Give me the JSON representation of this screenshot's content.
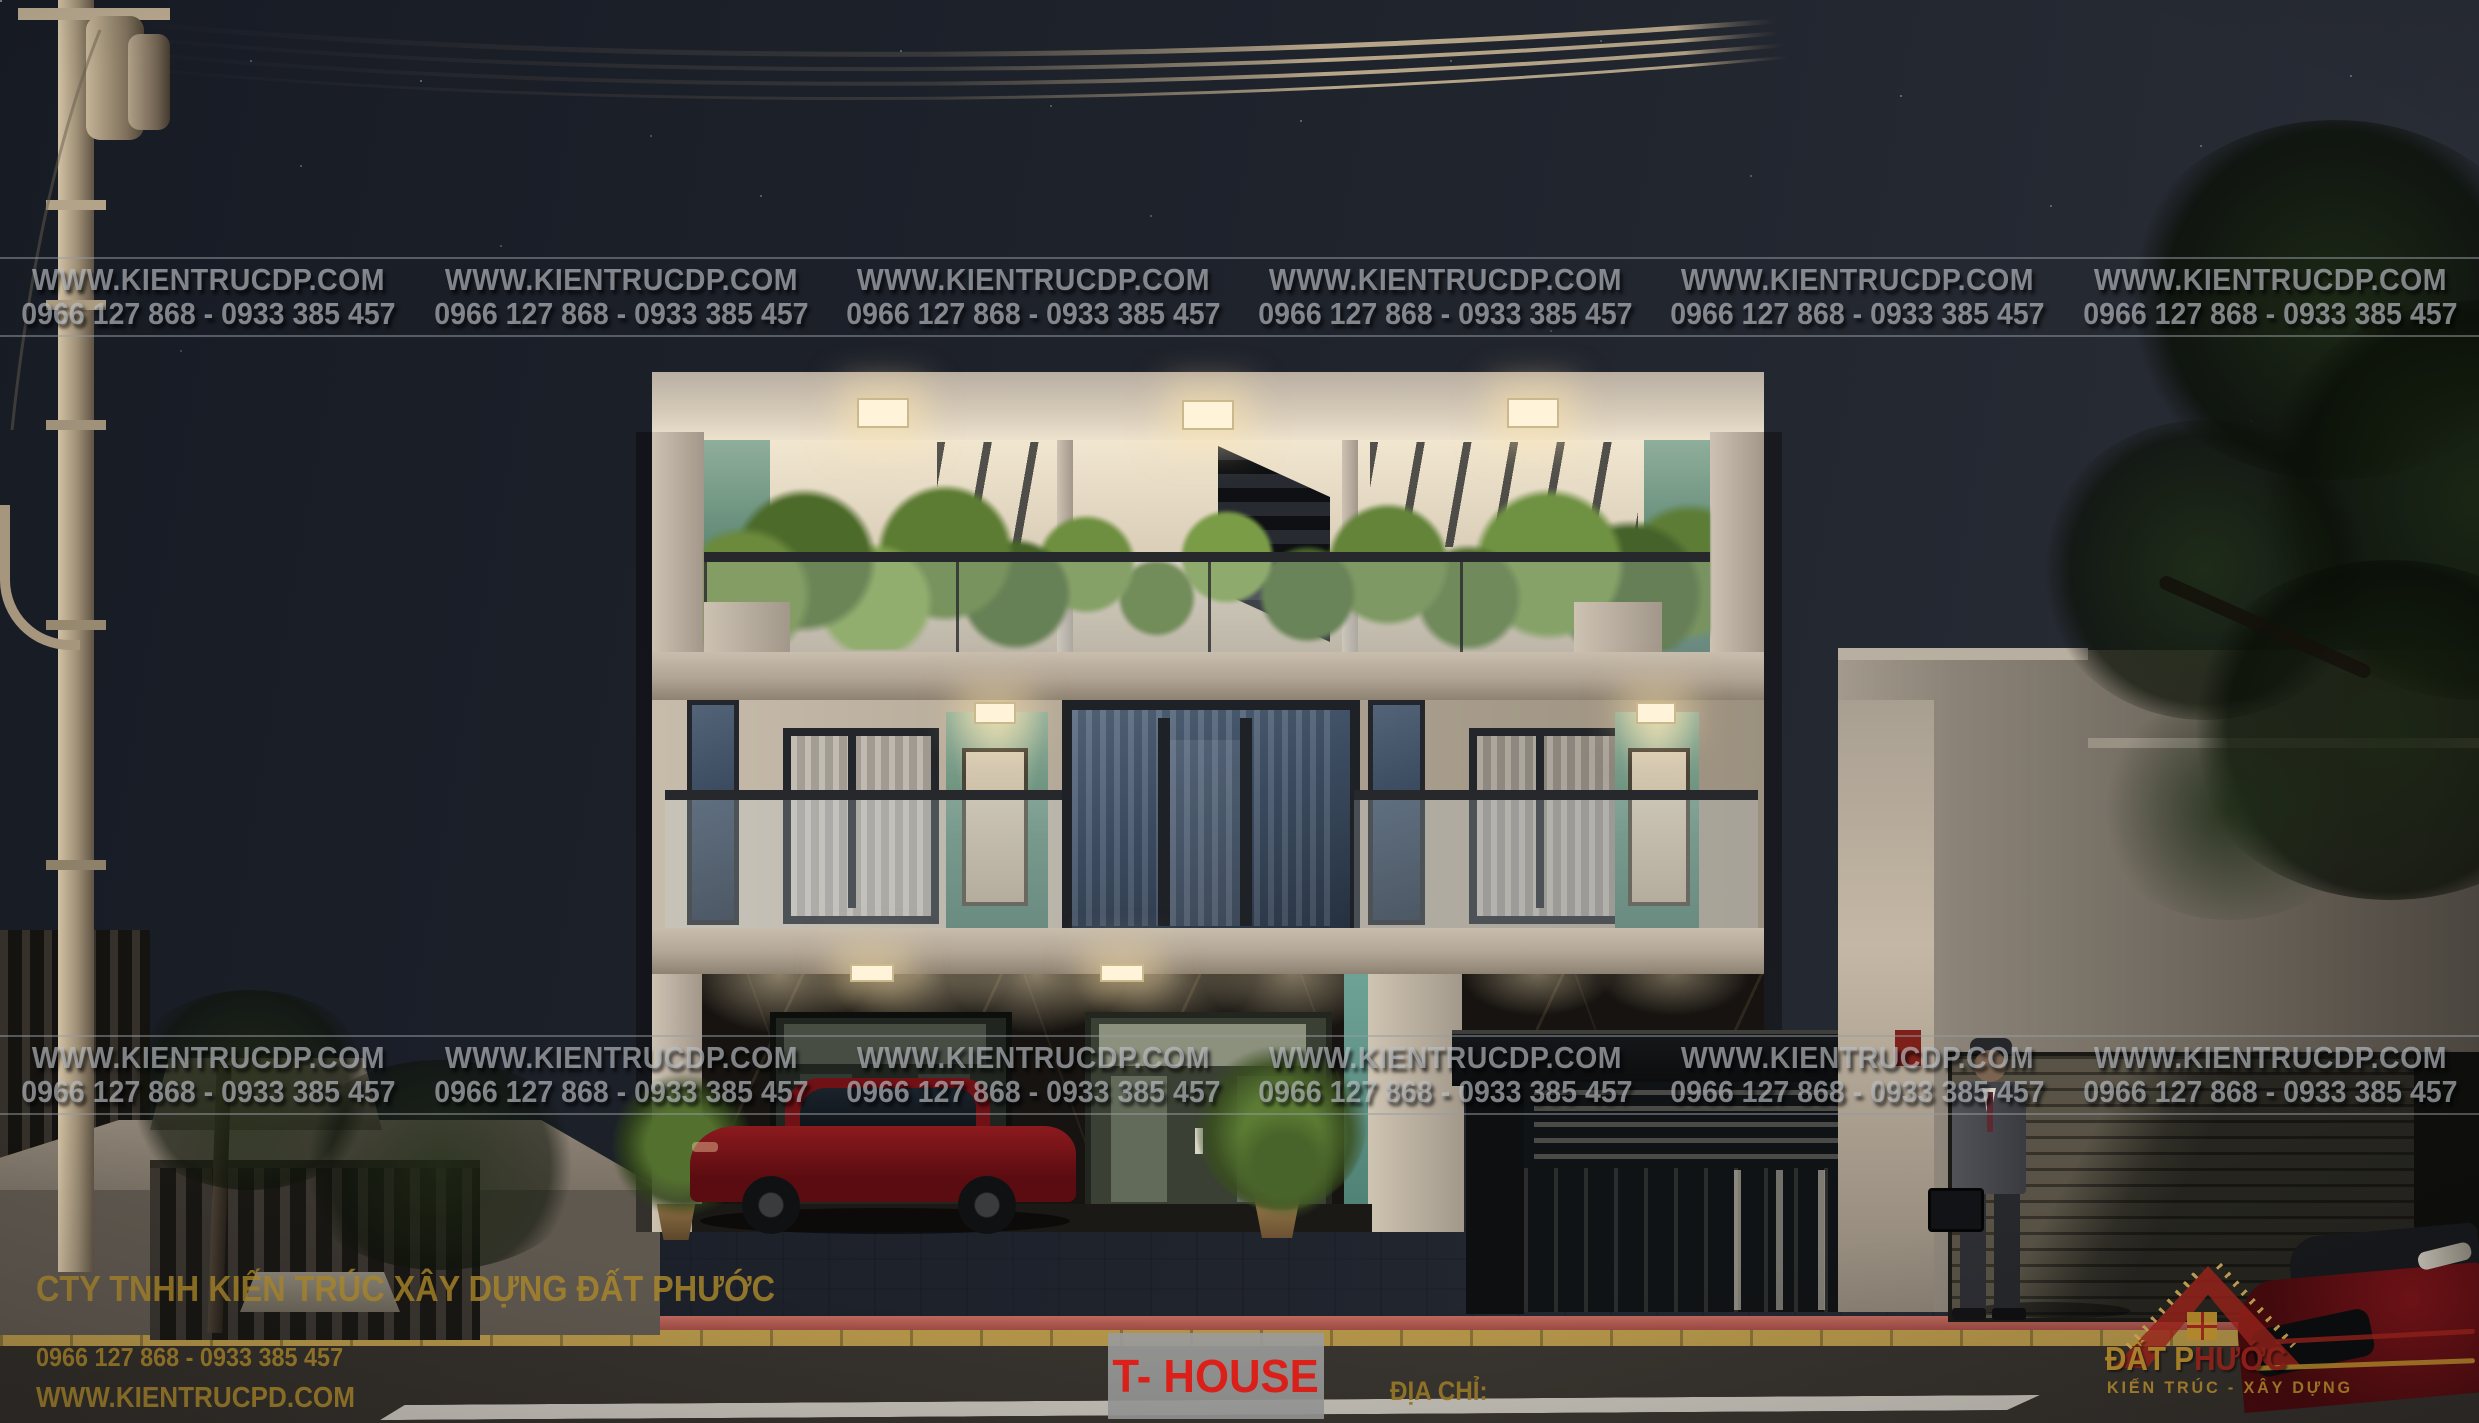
{
  "watermark": {
    "site": "WWW.KIENTRUCDP.COM",
    "phone": "0966 127 868 - 0933 385 457"
  },
  "footer": {
    "company": "CTY TNHH KIẾN TRÚC XÂY DỰNG ĐẤT PHƯỚC",
    "phone": "0966 127 868 - 0933 385 457",
    "website": "WWW.KIENTRUCPD.COM"
  },
  "plate": {
    "label": "T- HOUSE"
  },
  "address": {
    "label": "ĐỊA CHỈ:"
  },
  "logo": {
    "part1": "ĐẤT",
    "part2": "P",
    "part3": "HƯỚC",
    "tagline": "KIẾN TRÚC - XÂY DỰNG"
  },
  "colors": {
    "gold_text": "#b08c2a",
    "plate_red": "#e8211a",
    "watermark_gray": "#babfc5",
    "logo_red": "#a8261c",
    "logo_gold": "#c9992f"
  }
}
